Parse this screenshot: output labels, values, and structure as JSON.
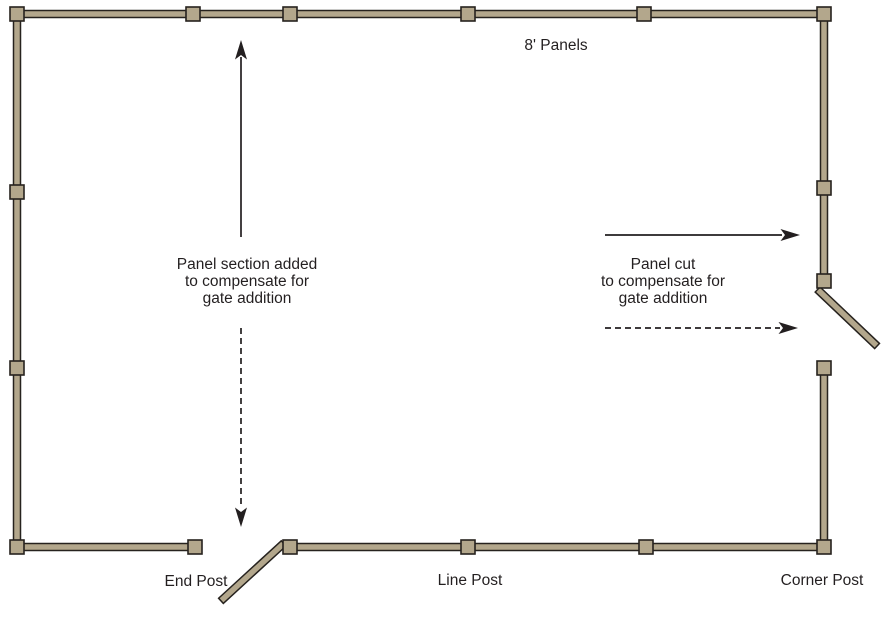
{
  "diagram": {
    "title": "Fence panel and gate layout",
    "top_label": "8' Panels",
    "left_annotation": {
      "line1": "Panel section added",
      "line2": "to compensate for",
      "line3": "gate addition"
    },
    "right_annotation": {
      "line1": "Panel cut",
      "line2": "to compensate for",
      "line3": "gate addition"
    },
    "post_labels": {
      "end_post": "End Post",
      "line_post": "Line Post",
      "corner_post": "Corner Post"
    },
    "colors": {
      "rail_fill": "#b3a78c",
      "rail_stroke": "#26221e",
      "ink": "#231f20",
      "background": "#ffffff"
    }
  }
}
